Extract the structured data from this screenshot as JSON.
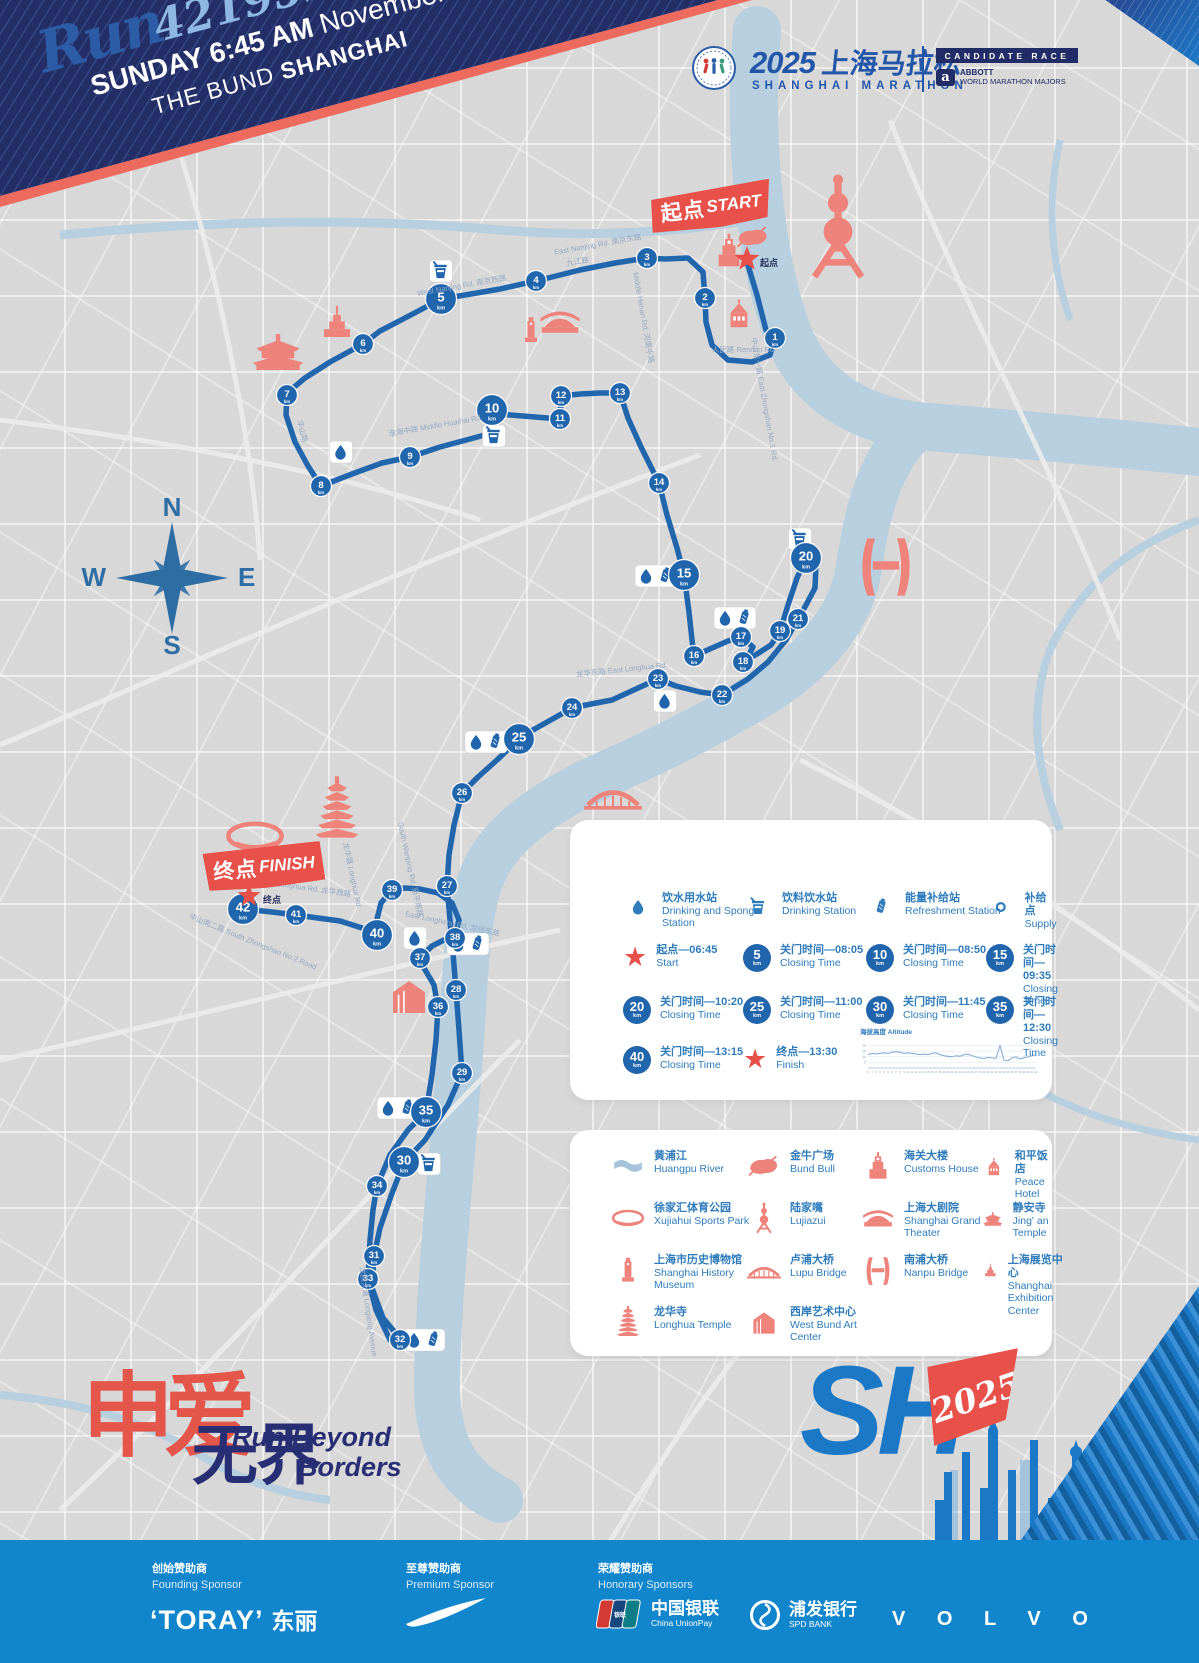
{
  "header": {
    "run_script": "Run",
    "run_number": "42195",
    "run_unit": "km",
    "line1_bold": "SUNDAY 6:45 AM",
    "line1_light": "November.30",
    "line2_light": "THE BUND",
    "line2_bold": "SHANGHAI"
  },
  "brand": {
    "title_year": "2025",
    "title_zh": "上海马拉松",
    "subtitle": "SHANGHAI MARATHON",
    "candidate": "CANDIDATE RACE",
    "abbott_a": "a",
    "abbott": "ABBOTT",
    "wmm": "WORLD MARATHON MAJORS"
  },
  "map": {
    "compass": {
      "n": "N",
      "e": "E",
      "s": "S",
      "w": "W"
    },
    "km_unit": "km",
    "start_banner_zh": "起点",
    "start_banner_en": "START",
    "start_label": "起点",
    "finish_banner_zh": "终点",
    "finish_banner_en": "FINISH",
    "finish_label": "终点",
    "road_labels": [
      {
        "t": "East Nanjing Rd. 南京东路",
        "x": 598,
        "y": 247,
        "r": -10
      },
      {
        "t": "West Nanjing Rd. 南京西路",
        "x": 462,
        "y": 288,
        "r": -10
      },
      {
        "t": "九江路",
        "x": 578,
        "y": 264,
        "r": -10
      },
      {
        "t": "Middle Henan Rd. 河南中路",
        "x": 641,
        "y": 318,
        "r": 80
      },
      {
        "t": "中山东一路 East Zhongshan No.1 Rd.",
        "x": 762,
        "y": 400,
        "r": 80
      },
      {
        "t": "人民路 Renmin Rd.",
        "x": 744,
        "y": 352,
        "r": 0
      },
      {
        "t": "淮海中路 Middle Huaihai Rd.",
        "x": 436,
        "y": 428,
        "r": -10
      },
      {
        "t": "华山路",
        "x": 300,
        "y": 432,
        "r": 75
      },
      {
        "t": "龙华东路 East Longhua Rd.",
        "x": 622,
        "y": 672,
        "r": -6
      },
      {
        "t": "中山南二路 South Zhongshan No.2 Road",
        "x": 252,
        "y": 944,
        "r": 22
      },
      {
        "t": "龙腾大道 Longteng Avenue",
        "x": 366,
        "y": 1312,
        "r": 82
      },
      {
        "t": "South Wanping Rd. 宛平南路",
        "x": 408,
        "y": 870,
        "r": 78
      },
      {
        "t": "龙华路 Longhua Rd.",
        "x": 350,
        "y": 876,
        "r": 78
      },
      {
        "t": "West Longhua Rd. 龙华西路",
        "x": 304,
        "y": 890,
        "r": 8
      },
      {
        "t": "East Longheng Rd. 龙恒东路",
        "x": 452,
        "y": 926,
        "r": 12
      }
    ],
    "km_markers": [
      {
        "km": 1,
        "x": 775,
        "y": 338,
        "major": false
      },
      {
        "km": 2,
        "x": 705,
        "y": 298,
        "major": false
      },
      {
        "km": 3,
        "x": 647,
        "y": 258,
        "major": false
      },
      {
        "km": 4,
        "x": 536,
        "y": 281,
        "major": false
      },
      {
        "km": 5,
        "x": 441,
        "y": 299,
        "major": true
      },
      {
        "km": 6,
        "x": 363,
        "y": 344,
        "major": false
      },
      {
        "km": 7,
        "x": 287,
        "y": 395,
        "major": false
      },
      {
        "km": 8,
        "x": 321,
        "y": 486,
        "major": false
      },
      {
        "km": 9,
        "x": 410,
        "y": 457,
        "major": false
      },
      {
        "km": 10,
        "x": 492,
        "y": 410,
        "major": true
      },
      {
        "km": 11,
        "x": 560,
        "y": 419,
        "major": false
      },
      {
        "km": 12,
        "x": 561,
        "y": 396,
        "major": false
      },
      {
        "km": 13,
        "x": 620,
        "y": 393,
        "major": false
      },
      {
        "km": 14,
        "x": 659,
        "y": 483,
        "major": false
      },
      {
        "km": 15,
        "x": 684,
        "y": 575,
        "major": true
      },
      {
        "km": 16,
        "x": 694,
        "y": 656,
        "major": false
      },
      {
        "km": 17,
        "x": 741,
        "y": 637,
        "major": false
      },
      {
        "km": 18,
        "x": 743,
        "y": 662,
        "major": false
      },
      {
        "km": 19,
        "x": 780,
        "y": 631,
        "major": false
      },
      {
        "km": 20,
        "x": 806,
        "y": 558,
        "major": true
      },
      {
        "km": 21,
        "x": 798,
        "y": 619,
        "major": false
      },
      {
        "km": 22,
        "x": 722,
        "y": 695,
        "major": false
      },
      {
        "km": 23,
        "x": 658,
        "y": 679,
        "major": false
      },
      {
        "km": 24,
        "x": 572,
        "y": 708,
        "major": false
      },
      {
        "km": 25,
        "x": 519,
        "y": 739,
        "major": true
      },
      {
        "km": 26,
        "x": 462,
        "y": 793,
        "major": false
      },
      {
        "km": 27,
        "x": 447,
        "y": 886,
        "major": false
      },
      {
        "km": 28,
        "x": 456,
        "y": 990,
        "major": false
      },
      {
        "km": 29,
        "x": 462,
        "y": 1073,
        "major": false
      },
      {
        "km": 30,
        "x": 404,
        "y": 1162,
        "major": true
      },
      {
        "km": 31,
        "x": 374,
        "y": 1256,
        "major": false
      },
      {
        "km": 32,
        "x": 400,
        "y": 1340,
        "major": false
      },
      {
        "km": 33,
        "x": 368,
        "y": 1279,
        "major": false
      },
      {
        "km": 34,
        "x": 377,
        "y": 1186,
        "major": false
      },
      {
        "km": 35,
        "x": 426,
        "y": 1112,
        "major": true
      },
      {
        "km": 36,
        "x": 438,
        "y": 1007,
        "major": false
      },
      {
        "km": 37,
        "x": 420,
        "y": 958,
        "major": false
      },
      {
        "km": 38,
        "x": 455,
        "y": 938,
        "major": false
      },
      {
        "km": 39,
        "x": 392,
        "y": 890,
        "major": false
      },
      {
        "km": 40,
        "x": 377,
        "y": 935,
        "major": true
      },
      {
        "km": 41,
        "x": 296,
        "y": 915,
        "major": false
      },
      {
        "km": 42,
        "x": 243,
        "y": 909,
        "major": true
      }
    ],
    "stations": [
      {
        "x": 441,
        "y": 271,
        "icons": [
          "cup"
        ]
      },
      {
        "x": 341,
        "y": 452,
        "icons": [
          "drop"
        ]
      },
      {
        "x": 494,
        "y": 436,
        "icons": [
          "cup"
        ]
      },
      {
        "x": 800,
        "y": 539,
        "icons": [
          "cup"
        ]
      },
      {
        "x": 656,
        "y": 576,
        "icons": [
          "drop",
          "gel"
        ]
      },
      {
        "x": 735,
        "y": 618,
        "icons": [
          "drop",
          "gel"
        ]
      },
      {
        "x": 665,
        "y": 701,
        "icons": [
          "drop"
        ]
      },
      {
        "x": 486,
        "y": 742,
        "icons": [
          "drop",
          "gel"
        ]
      },
      {
        "x": 415,
        "y": 938,
        "icons": [
          "drop"
        ]
      },
      {
        "x": 468,
        "y": 944,
        "icons": [
          "drop",
          "gel"
        ]
      },
      {
        "x": 398,
        "y": 1108,
        "icons": [
          "drop",
          "gel"
        ]
      },
      {
        "x": 429,
        "y": 1164,
        "icons": [
          "cup"
        ]
      },
      {
        "x": 424,
        "y": 1340,
        "icons": [
          "drop",
          "gel"
        ]
      }
    ],
    "landmarks": [
      {
        "type": "pearl",
        "x": 838,
        "y": 230,
        "s": 3.6
      },
      {
        "type": "customs",
        "x": 729,
        "y": 252,
        "s": 1.3
      },
      {
        "type": "bull",
        "x": 753,
        "y": 238,
        "s": 1.1
      },
      {
        "type": "peace",
        "x": 739,
        "y": 314,
        "s": 1.2
      },
      {
        "type": "theater",
        "x": 560,
        "y": 323,
        "s": 1.4
      },
      {
        "type": "museum",
        "x": 531,
        "y": 331,
        "s": 1.1
      },
      {
        "type": "temple",
        "x": 278,
        "y": 352,
        "s": 1.8
      },
      {
        "type": "exhibition",
        "x": 337,
        "y": 324,
        "s": 1.3
      },
      {
        "type": "nanpu",
        "x": 886,
        "y": 567,
        "s": 2.2
      },
      {
        "type": "lupu",
        "x": 613,
        "y": 797,
        "s": 1.8
      },
      {
        "type": "pagoda",
        "x": 337,
        "y": 812,
        "s": 2.1
      },
      {
        "type": "stadium",
        "x": 255,
        "y": 838,
        "s": 1.9
      },
      {
        "type": "westbund",
        "x": 409,
        "y": 997,
        "s": 1.6
      }
    ],
    "route_points": [
      [
        747,
        262
      ],
      [
        757,
        295
      ],
      [
        766,
        330
      ],
      [
        775,
        338
      ],
      [
        770,
        355
      ],
      [
        752,
        362
      ],
      [
        728,
        360
      ],
      [
        712,
        345
      ],
      [
        706,
        322
      ],
      [
        705,
        298
      ],
      [
        703,
        272
      ],
      [
        688,
        258
      ],
      [
        665,
        259
      ],
      [
        647,
        258
      ],
      [
        615,
        263
      ],
      [
        580,
        270
      ],
      [
        536,
        281
      ],
      [
        500,
        289
      ],
      [
        465,
        295
      ],
      [
        441,
        299
      ],
      [
        405,
        318
      ],
      [
        380,
        331
      ],
      [
        363,
        344
      ],
      [
        330,
        362
      ],
      [
        305,
        378
      ],
      [
        287,
        393
      ],
      [
        286,
        415
      ],
      [
        295,
        442
      ],
      [
        308,
        466
      ],
      [
        321,
        486
      ],
      [
        352,
        474
      ],
      [
        382,
        463
      ],
      [
        410,
        457
      ],
      [
        440,
        447
      ],
      [
        470,
        439
      ],
      [
        492,
        433
      ],
      [
        492,
        412
      ],
      [
        510,
        415
      ],
      [
        535,
        417
      ],
      [
        560,
        419
      ],
      [
        561,
        396
      ],
      [
        580,
        394
      ],
      [
        600,
        393
      ],
      [
        620,
        393
      ],
      [
        628,
        418
      ],
      [
        641,
        447
      ],
      [
        659,
        483
      ],
      [
        667,
        515
      ],
      [
        677,
        548
      ],
      [
        684,
        575
      ],
      [
        689,
        612
      ],
      [
        692,
        640
      ],
      [
        694,
        656
      ],
      [
        712,
        648
      ],
      [
        728,
        641
      ],
      [
        741,
        637
      ],
      [
        753,
        647
      ],
      [
        747,
        658
      ],
      [
        743,
        662
      ],
      [
        757,
        654
      ],
      [
        771,
        645
      ],
      [
        780,
        631
      ],
      [
        788,
        605
      ],
      [
        797,
        578
      ],
      [
        806,
        558
      ],
      [
        816,
        565
      ],
      [
        815,
        588
      ],
      [
        806,
        605
      ],
      [
        798,
        619
      ],
      [
        786,
        640
      ],
      [
        768,
        662
      ],
      [
        748,
        679
      ],
      [
        722,
        695
      ],
      [
        700,
        692
      ],
      [
        676,
        686
      ],
      [
        658,
        679
      ],
      [
        636,
        689
      ],
      [
        612,
        700
      ],
      [
        591,
        704
      ],
      [
        572,
        708
      ],
      [
        549,
        721
      ],
      [
        533,
        730
      ],
      [
        519,
        739
      ],
      [
        497,
        760
      ],
      [
        478,
        777
      ],
      [
        462,
        793
      ],
      [
        454,
        825
      ],
      [
        449,
        855
      ],
      [
        447,
        886
      ],
      [
        450,
        920
      ],
      [
        453,
        953
      ],
      [
        456,
        990
      ],
      [
        459,
        1030
      ],
      [
        462,
        1073
      ],
      [
        448,
        1105
      ],
      [
        425,
        1140
      ],
      [
        404,
        1162
      ],
      [
        391,
        1196
      ],
      [
        380,
        1228
      ],
      [
        374,
        1256
      ],
      [
        372,
        1288
      ],
      [
        383,
        1318
      ],
      [
        398,
        1336
      ],
      [
        400,
        1344
      ],
      [
        390,
        1340
      ],
      [
        376,
        1310
      ],
      [
        368,
        1279
      ],
      [
        370,
        1240
      ],
      [
        373,
        1210
      ],
      [
        377,
        1186
      ],
      [
        390,
        1155
      ],
      [
        408,
        1130
      ],
      [
        426,
        1112
      ],
      [
        432,
        1075
      ],
      [
        436,
        1040
      ],
      [
        438,
        1007
      ],
      [
        434,
        985
      ],
      [
        424,
        968
      ],
      [
        420,
        958
      ],
      [
        432,
        946
      ],
      [
        444,
        940
      ],
      [
        455,
        938
      ],
      [
        459,
        920
      ],
      [
        452,
        903
      ],
      [
        438,
        893
      ],
      [
        420,
        889
      ],
      [
        405,
        888
      ],
      [
        392,
        890
      ],
      [
        381,
        903
      ],
      [
        377,
        919
      ],
      [
        377,
        935
      ],
      [
        362,
        928
      ],
      [
        340,
        921
      ],
      [
        318,
        918
      ],
      [
        296,
        915
      ],
      [
        272,
        912
      ],
      [
        243,
        909
      ]
    ]
  },
  "legend_services": {
    "stations": [
      {
        "icon": "drop",
        "zh": "饮水用水站",
        "en": "Drinking and Sponge Station"
      },
      {
        "icon": "cup",
        "zh": "饮料饮水站",
        "en": "Drinking Station"
      },
      {
        "icon": "gel",
        "zh": "能量补给站",
        "en": "Refreshment Station"
      },
      {
        "icon": "ring",
        "zh": "补给点",
        "en": "Supply"
      }
    ],
    "times": [
      {
        "star": true,
        "zh": "起点—06:45",
        "en": "Start"
      },
      {
        "badge": "5",
        "zh": "关门时间—08:05",
        "en": "Closing Time"
      },
      {
        "badge": "10",
        "zh": "关门时间—08:50",
        "en": "Closing Time"
      },
      {
        "badge": "15",
        "zh": "关门时间—09:35",
        "en": "Closing Time"
      },
      {
        "badge": "20",
        "zh": "关门时间—10:20",
        "en": "Closing Time"
      },
      {
        "badge": "25",
        "zh": "关门时间—11:00",
        "en": "Closing Time"
      },
      {
        "badge": "30",
        "zh": "关门时间—11:45",
        "en": "Closing Time"
      },
      {
        "badge": "35",
        "zh": "关门时间—12:30",
        "en": "Closing Time"
      },
      {
        "badge": "40",
        "zh": "关门时间—13:15",
        "en": "Closing Time"
      },
      {
        "star": true,
        "zh": "终点—13:30",
        "en": "Finish"
      }
    ]
  },
  "chart_data": {
    "type": "line",
    "title": "海拔高度 Altitude",
    "xlabel": "km",
    "ylabel": "m",
    "x": [
      0,
      1,
      2,
      3,
      4,
      5,
      6,
      7,
      8,
      9,
      10,
      11,
      12,
      13,
      14,
      15,
      16,
      17,
      18,
      19,
      20,
      21,
      22,
      23,
      24,
      25,
      26,
      27,
      28,
      29,
      30,
      31,
      32,
      33,
      34,
      35,
      36,
      37,
      38,
      39,
      40,
      41,
      42
    ],
    "values": [
      12,
      13,
      12.5,
      13,
      13.5,
      13,
      14,
      14.5,
      14,
      13,
      13.5,
      13,
      12.5,
      12,
      12.5,
      12,
      13,
      13.5,
      12,
      11,
      10.5,
      10,
      11,
      10.5,
      12,
      12.5,
      11,
      10,
      9,
      8.5,
      9.5,
      9,
      8.5,
      20,
      7,
      6.5,
      9,
      10,
      8,
      9,
      10,
      11,
      12
    ],
    "ylim": [
      0,
      25
    ],
    "yticks": [
      5,
      10,
      15,
      20
    ]
  },
  "legend_landmarks": {
    "items": [
      {
        "icon": "river",
        "zh": "黄浦江",
        "en": "Huangpu River"
      },
      {
        "icon": "bull",
        "zh": "金牛广场",
        "en": "Bund Bull"
      },
      {
        "icon": "customs",
        "zh": "海关大楼",
        "en": "Customs House"
      },
      {
        "icon": "peace",
        "zh": "和平饭店",
        "en": "Peace Hotel"
      },
      {
        "icon": "stadium",
        "zh": "徐家汇体育公园",
        "en": "Xujiahui Sports Park"
      },
      {
        "icon": "pearl",
        "zh": "陆家嘴",
        "en": "Lujiazui"
      },
      {
        "icon": "theater",
        "zh": "上海大剧院",
        "en": "Shanghai Grand Theater"
      },
      {
        "icon": "temple",
        "zh": "静安寺",
        "en": "Jing' an Temple"
      },
      {
        "icon": "museum",
        "zh": "上海市历史博物馆",
        "en": "Shanghai History Museum"
      },
      {
        "icon": "lupu",
        "zh": "卢浦大桥",
        "en": "Lupu Bridge"
      },
      {
        "icon": "nanpu",
        "zh": "南浦大桥",
        "en": "Nanpu Bridge"
      },
      {
        "icon": "exhibition",
        "zh": "上海展览中心",
        "en": "Shanghai Exhibition Center"
      },
      {
        "icon": "pagoda",
        "zh": "龙华寺",
        "en": "Longhua Temple"
      },
      {
        "icon": "westbund",
        "zh": "西岸艺术中心",
        "en": "West Bund Art Center"
      }
    ]
  },
  "footer_logo": {
    "zh_red": "申爱",
    "zh_blue": "无界",
    "en_line1": "Run Beyond",
    "en_line2": "Borders"
  },
  "sh_badge": {
    "text": "SH",
    "year": "2025"
  },
  "sponsors": {
    "founding_zh": "创始赞助商",
    "founding_en": "Founding Sponsor",
    "toray": "‘TORAY’",
    "toray_zh": "东丽",
    "premium_zh": "至尊赞助商",
    "premium_en": "Premium Sponsor",
    "honorary_zh": "荣耀赞助商",
    "honorary_en": "Honorary Sponsors",
    "unionpay_zh": "中国银联",
    "unionpay_en": "China UnionPay",
    "unionpay_card": "银联",
    "spd_zh": "浦发银行",
    "spd_en": "SPD BANK",
    "volvo": "V O L V O"
  }
}
